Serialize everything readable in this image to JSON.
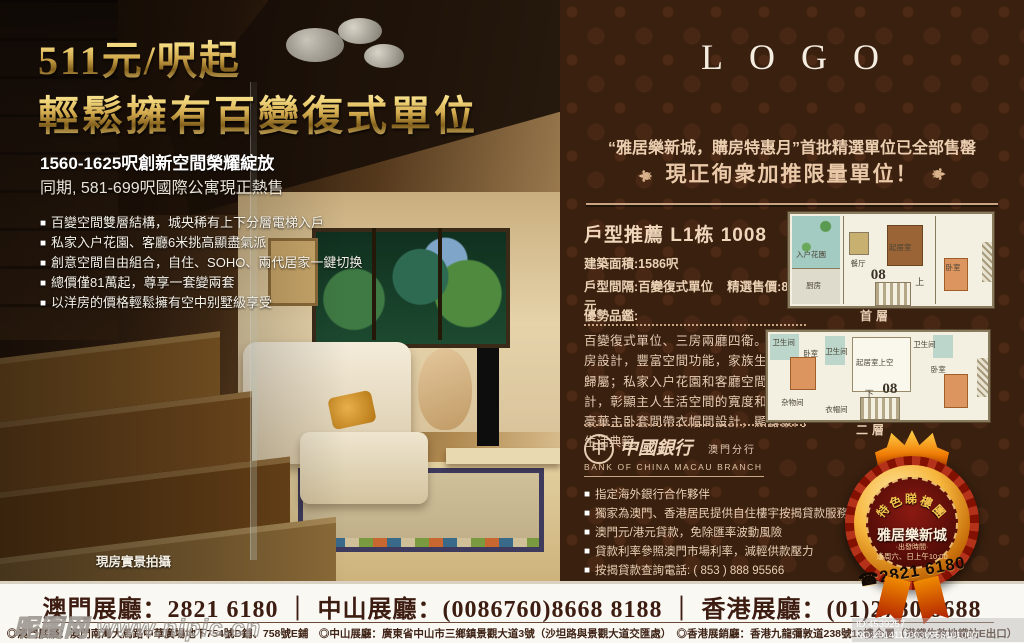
{
  "icons": {
    "bullet": "■",
    "ornament": "⚜",
    "phone": "☎",
    "marker": "◎"
  },
  "colors": {
    "gold_accent": "#e8c06a",
    "panel_background": "#39200f",
    "cream_text": "#ecd2b4",
    "badge_red": "#7a1410",
    "footer_text": "#3d1d12"
  },
  "left": {
    "title_line1": "511元/呎起",
    "title_line2": "輕鬆擁有百變復式單位",
    "subtitle_bold": "1560-1625呎創新空間榮耀綻放",
    "subtitle": "同期, 581-699呎國際公寓現正熱售",
    "bullets": [
      "百變空間雙層結構，城央稀有上下分層電梯入戶",
      "私家入户花園、客廳6米挑高顯盡氣派",
      "創意空間自由組合，自住、SOHO、兩代居家一鍵切换",
      "總價僅81萬起，尊享一套變兩套",
      "以洋房的價格輕鬆擁有空中别墅級享受"
    ],
    "photo_caption": "現房實景拍攝"
  },
  "right": {
    "logo_text": "LOGO",
    "promo_line1": "“雅居樂新城，購房特惠月”首批精選單位已全部售罄",
    "promo_line2": "現正徇衆加推限量單位！",
    "unit": {
      "heading": "戶型推薦  L1栋  1008",
      "area": "建築面積:1586呎",
      "layout": "戶型間隔:百變復式單位",
      "price": "精選售價:81萬元",
      "advantage_label": "優勢品鑑:",
      "description": "百變復式單位、三房兩廳四衛。闊綽三房設計，豐富空間功能，家族生活顯赫歸屬；私家入户花園和客廳空間挑高設計，彰顯主人生活空間的寬度和高度；豪華主卧套間帶衣帽間設計，顯露豪門生活典範。"
    },
    "bank": {
      "logo_char": "中",
      "name_cn": "中國銀行",
      "branch_cn": "澳門分行",
      "name_en": "BANK OF CHINA MACAU BRANCH",
      "bullets": [
        "指定海外銀行合作夥伴",
        "獨家為澳門、香港居民提供自住樓宇按揭貸款服務",
        "澳門元/港元貸款，免除匯率波動風險",
        "貸款利率參照澳門市場利率，減輕供款壓力",
        "按揭貸款查詢電話: ( 853 ) 888 95566"
      ]
    },
    "floorplans": [
      {
        "caption": "首層",
        "unit_no": "08",
        "stair_label": "上",
        "rooms": [
          "入户花園",
          "厨房",
          "餐厅",
          "起居室",
          "卧室"
        ]
      },
      {
        "caption": "二層",
        "unit_no": "08",
        "stair_label": "下",
        "rooms": [
          "卫生间",
          "卧室",
          "卫生间",
          "起居室上空",
          "卫生间",
          "卧室",
          "杂物间",
          "衣帽间"
        ]
      }
    ],
    "badge": {
      "arc_chars": [
        "特",
        "色",
        "睇",
        "樓",
        "團"
      ],
      "title": "雅居樂新城",
      "sub1": "·出發時間·",
      "sub2": "逢周六、日上午10:00",
      "phone": "2821 6180"
    }
  },
  "footer": {
    "hotlines": "澳門展廳：2821 6180 ｜ 中山展廳：(0086760)8668 8188 ｜ 香港展廳：(01)2780 8688",
    "addresses": "◎澳門展廳：澳門南灣大馬路中華廣場地下754號D鋪、758號E鋪　◎中山展廳：廣東省中山市三鄉鎮景觀大道3號（沙坦路與景觀大道交匯處）　◎香港展銷廳：香港九龍彌敦道238號12樓全層（港鐵佐敦地鐵站E出口）"
  },
  "watermarks": {
    "site": "昵图网 www.nipic.cn",
    "id_text": "ID:4539257 NO:20141110030956101000"
  }
}
